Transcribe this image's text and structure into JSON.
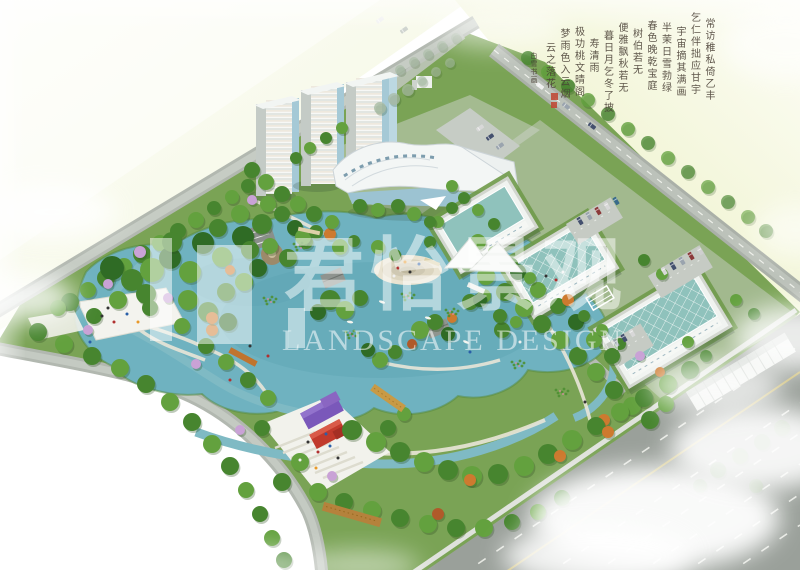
{
  "meta": {
    "kind": "aerial-landscape-design-rendering",
    "description": "Bird's-eye master-plan rendering of an eco-park: central lake with islands, three white residential towers, a wave-roof exhibition center, three glass-roof workshop buildings with parking, winding streams, plazas, wooden bridges, perimeter roads and soft cloud overlays."
  },
  "watermark": {
    "cn": "君怡景观",
    "cn_chars": [
      "君",
      "怡",
      "景",
      "观"
    ],
    "en": "LANDSCAPE DESIGN"
  },
  "calligraphy": {
    "reading_order": "vertical columns, right to left",
    "columns": [
      "常访稚私倚乙丰",
      "乞仁伴拙应甘宇",
      "宇宙摘其满画",
      "半茉日雪勃绿",
      "春色晚乾宝庭",
      "树伯若无",
      "便雅飘秋若无",
      "暮日月乞冬了披",
      "寿清雨",
      "极功桃文晴阁",
      "梦雨色入云烟",
      "云之落花"
    ],
    "signature": "白雪书画",
    "seal_count": 2,
    "seal_color": "#bf4430"
  },
  "site_elements": {
    "residential_towers": 3,
    "glass_workshops": 3,
    "exhibition_center": 1,
    "lake": 1,
    "circular_plazas": 2,
    "container_pavilions": "purple and red",
    "perimeter_roads": 4
  },
  "palette": {
    "water": "#6fb2c0",
    "park": "#7aa355",
    "field": "#eef3cf",
    "road": "#b2b8b0",
    "road_major": "#9aa09a",
    "glass": "#8fc2bc",
    "building": "#f3f6f5",
    "wood_bridge": "#c89a45",
    "container_purple": "#7a58ba",
    "container_red": "#c13a2c",
    "plaza": "#f2f2ec",
    "cloud": "#ffffff",
    "tree_green": "#47852f",
    "tree_autumn": "#cd7a2f",
    "lotus_pink": "#e08aa8"
  }
}
